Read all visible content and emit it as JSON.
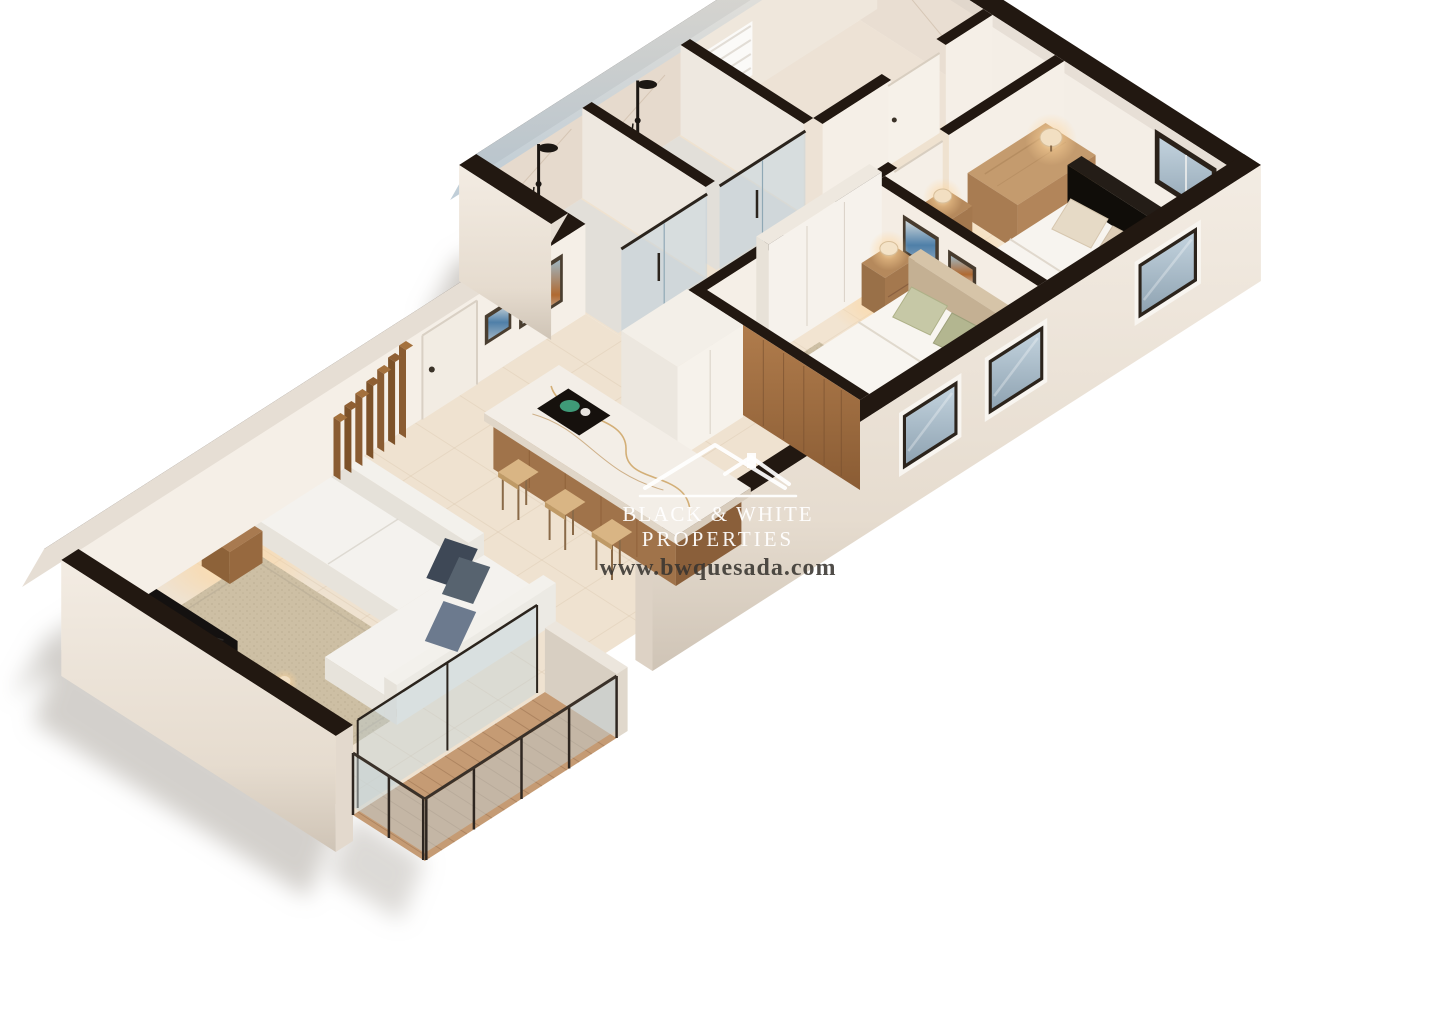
{
  "watermark": {
    "brand_line1": "BLACK & WHITE",
    "brand_line2": "PROPERTIES",
    "website": "www.bwquesada.com",
    "logo": "house-roof-icon"
  },
  "palette": {
    "background": "#ffffff",
    "wall_cut": "#221811",
    "exterior_wall": "#f2ebe2",
    "interior_wall": "#f5efe7",
    "floor_tile": "#efe2d0",
    "tile_line": "#ddcab2",
    "wood": "#a5744a",
    "wood_dark": "#8a5c34",
    "marble": "#f3eee7",
    "marble_vein": "#c89a52",
    "glass": "#b7cedb",
    "sky_glass": "#8fa3b2",
    "sofa": "#f4f2ee",
    "pillow_navy": "#3e4856",
    "pillow_sage": "#c6c8a6",
    "rug": "#cdbfa4",
    "lamp_glow": "#ffd59a",
    "deck_wood": "#c59b74",
    "shadow": "#a7a29a",
    "watermark_white": "#ffffff",
    "watermark_dark": "#383430"
  }
}
